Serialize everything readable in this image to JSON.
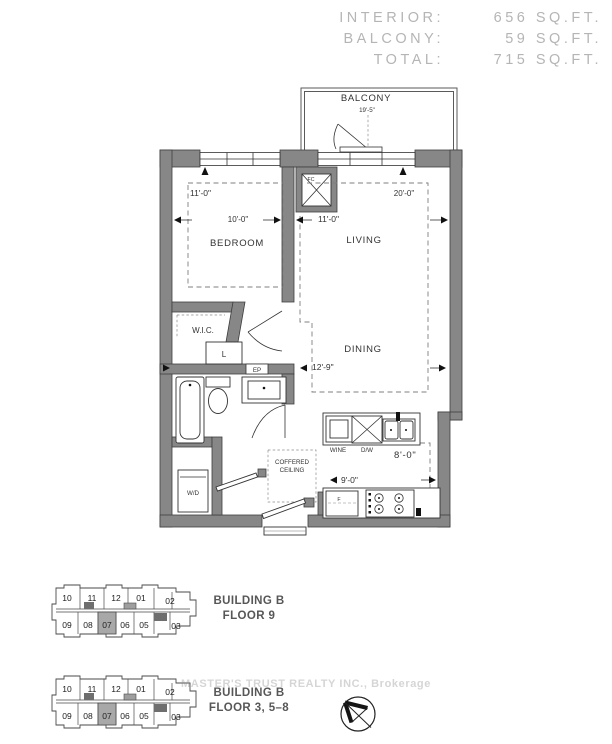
{
  "header": {
    "rows": [
      {
        "label": "INTERIOR:",
        "value": "656 SQ.FT."
      },
      {
        "label": "BALCONY:",
        "value": "59 SQ.FT."
      },
      {
        "label": "TOTAL:",
        "value": "715 SQ.FT."
      }
    ]
  },
  "floorplan": {
    "rooms": {
      "balcony": "BALCONY",
      "bedroom": "BEDROOM",
      "living": "LIVING",
      "dining": "DINING",
      "wic": "W.I.C.",
      "coffered_line1": "COFFERED",
      "coffered_line2": "CEILING",
      "wd": "W/D",
      "wine": "WINE",
      "dw": "D/W",
      "linen": "L",
      "ep": "EP",
      "fc": "FC",
      "fridge": "F"
    },
    "dimensions": {
      "balcony_width": "19'-5\"",
      "bedroom_width": "11'-0\"",
      "bedroom_depth": "10'-0\"",
      "living_length": "20'-0\"",
      "living_width": "11'-0\"",
      "dining_width": "12'-9\"",
      "kitchen_length": "9'-0\"",
      "kitchen_width": "8'-0\""
    }
  },
  "keyplans": [
    {
      "building": "BUILDING B",
      "floor": "FLOOR 9",
      "highlighted_unit": "07",
      "units_top": [
        "10",
        "11",
        "12",
        "01",
        "02"
      ],
      "units_bottom": [
        "09",
        "08",
        "07",
        "06",
        "05",
        "03"
      ]
    },
    {
      "building": "BUILDING B",
      "floor": "FLOOR 3, 5–8",
      "highlighted_unit": "07",
      "units_top": [
        "10",
        "11",
        "12",
        "01",
        "02"
      ],
      "units_bottom": [
        "09",
        "08",
        "07",
        "06",
        "05",
        "03"
      ]
    }
  ],
  "watermark": "MASTER'S TRUST REALTY INC., Brokerage",
  "icons": {
    "compass": "north-arrow-icon"
  },
  "colors": {
    "wall": "#878787",
    "line": "#3e3e3e",
    "header_text": "#b5b5b5",
    "highlight_unit": "#a8a8a8"
  }
}
